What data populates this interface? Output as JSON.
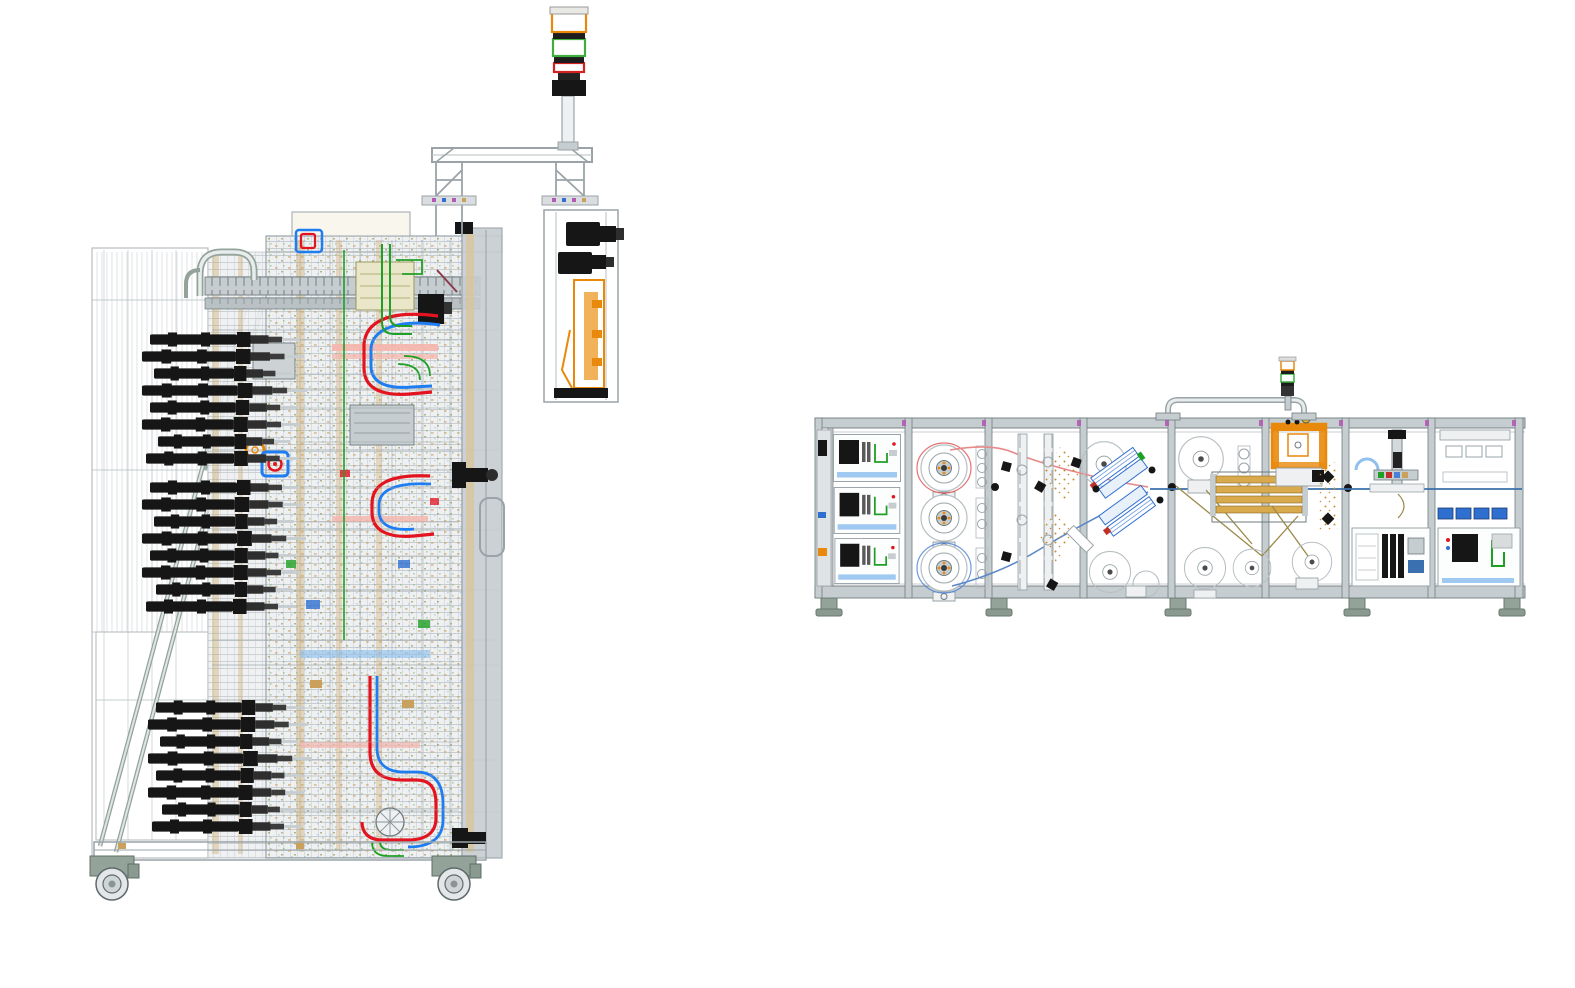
{
  "page": {
    "background": "#ffffff",
    "description": "CAD wireframe assembly drawing with two machine views, no UI chrome or text"
  },
  "palette": {
    "bg": "#ffffff",
    "frame": "#9aa4a8",
    "frameLight": "#c6cdd0",
    "frameFaint": "#b7bfc2",
    "frameDark": "#6f7a7e",
    "panel": "#eef0f1",
    "steelGreen": "#93a39a",
    "black": "#161616",
    "orange": "#e8890c",
    "orangeLight": "#f0a43c",
    "tan": "#c9a05c",
    "gold": "#d9a94e",
    "khaki": "#9a8a4a",
    "green": "#1ea024",
    "red": "#e31420",
    "blue": "#1f7df2",
    "blueMid": "#2f6fd0",
    "lightBlue": "#8fc0ee",
    "salmon": "#f5b5ac",
    "magenta": "#b35ab3",
    "towerGreen": "#3fae3f",
    "towerRed": "#d42222",
    "yellow": "#e2b61e",
    "maroon": "#8a3a4a",
    "web": "#3a6fa8"
  },
  "left_machine": {
    "name": "process-module-side-view",
    "signal_tower_segments": [
      "amber",
      "green",
      "red"
    ],
    "camera_count": 2,
    "actuator_banks": 3,
    "actuators_per_bank": 8,
    "caster_count": 2,
    "tube_colors": [
      "red",
      "blue",
      "green"
    ]
  },
  "right_machine": {
    "name": "assembly-line-front-view",
    "bay_count": 8,
    "unwind_spools": 3,
    "signal_tower_segments": [
      "amber",
      "green"
    ],
    "feet_count": 5,
    "bays": [
      {
        "kind": "electrical-cabinets"
      },
      {
        "kind": "unwind-spools"
      },
      {
        "kind": "vertical-tracks"
      },
      {
        "kind": "lamination-modules"
      },
      {
        "kind": "roller-stations"
      },
      {
        "kind": "press-fixture"
      },
      {
        "kind": "assembly-mechanism"
      },
      {
        "kind": "electrical-outfeed"
      }
    ]
  }
}
